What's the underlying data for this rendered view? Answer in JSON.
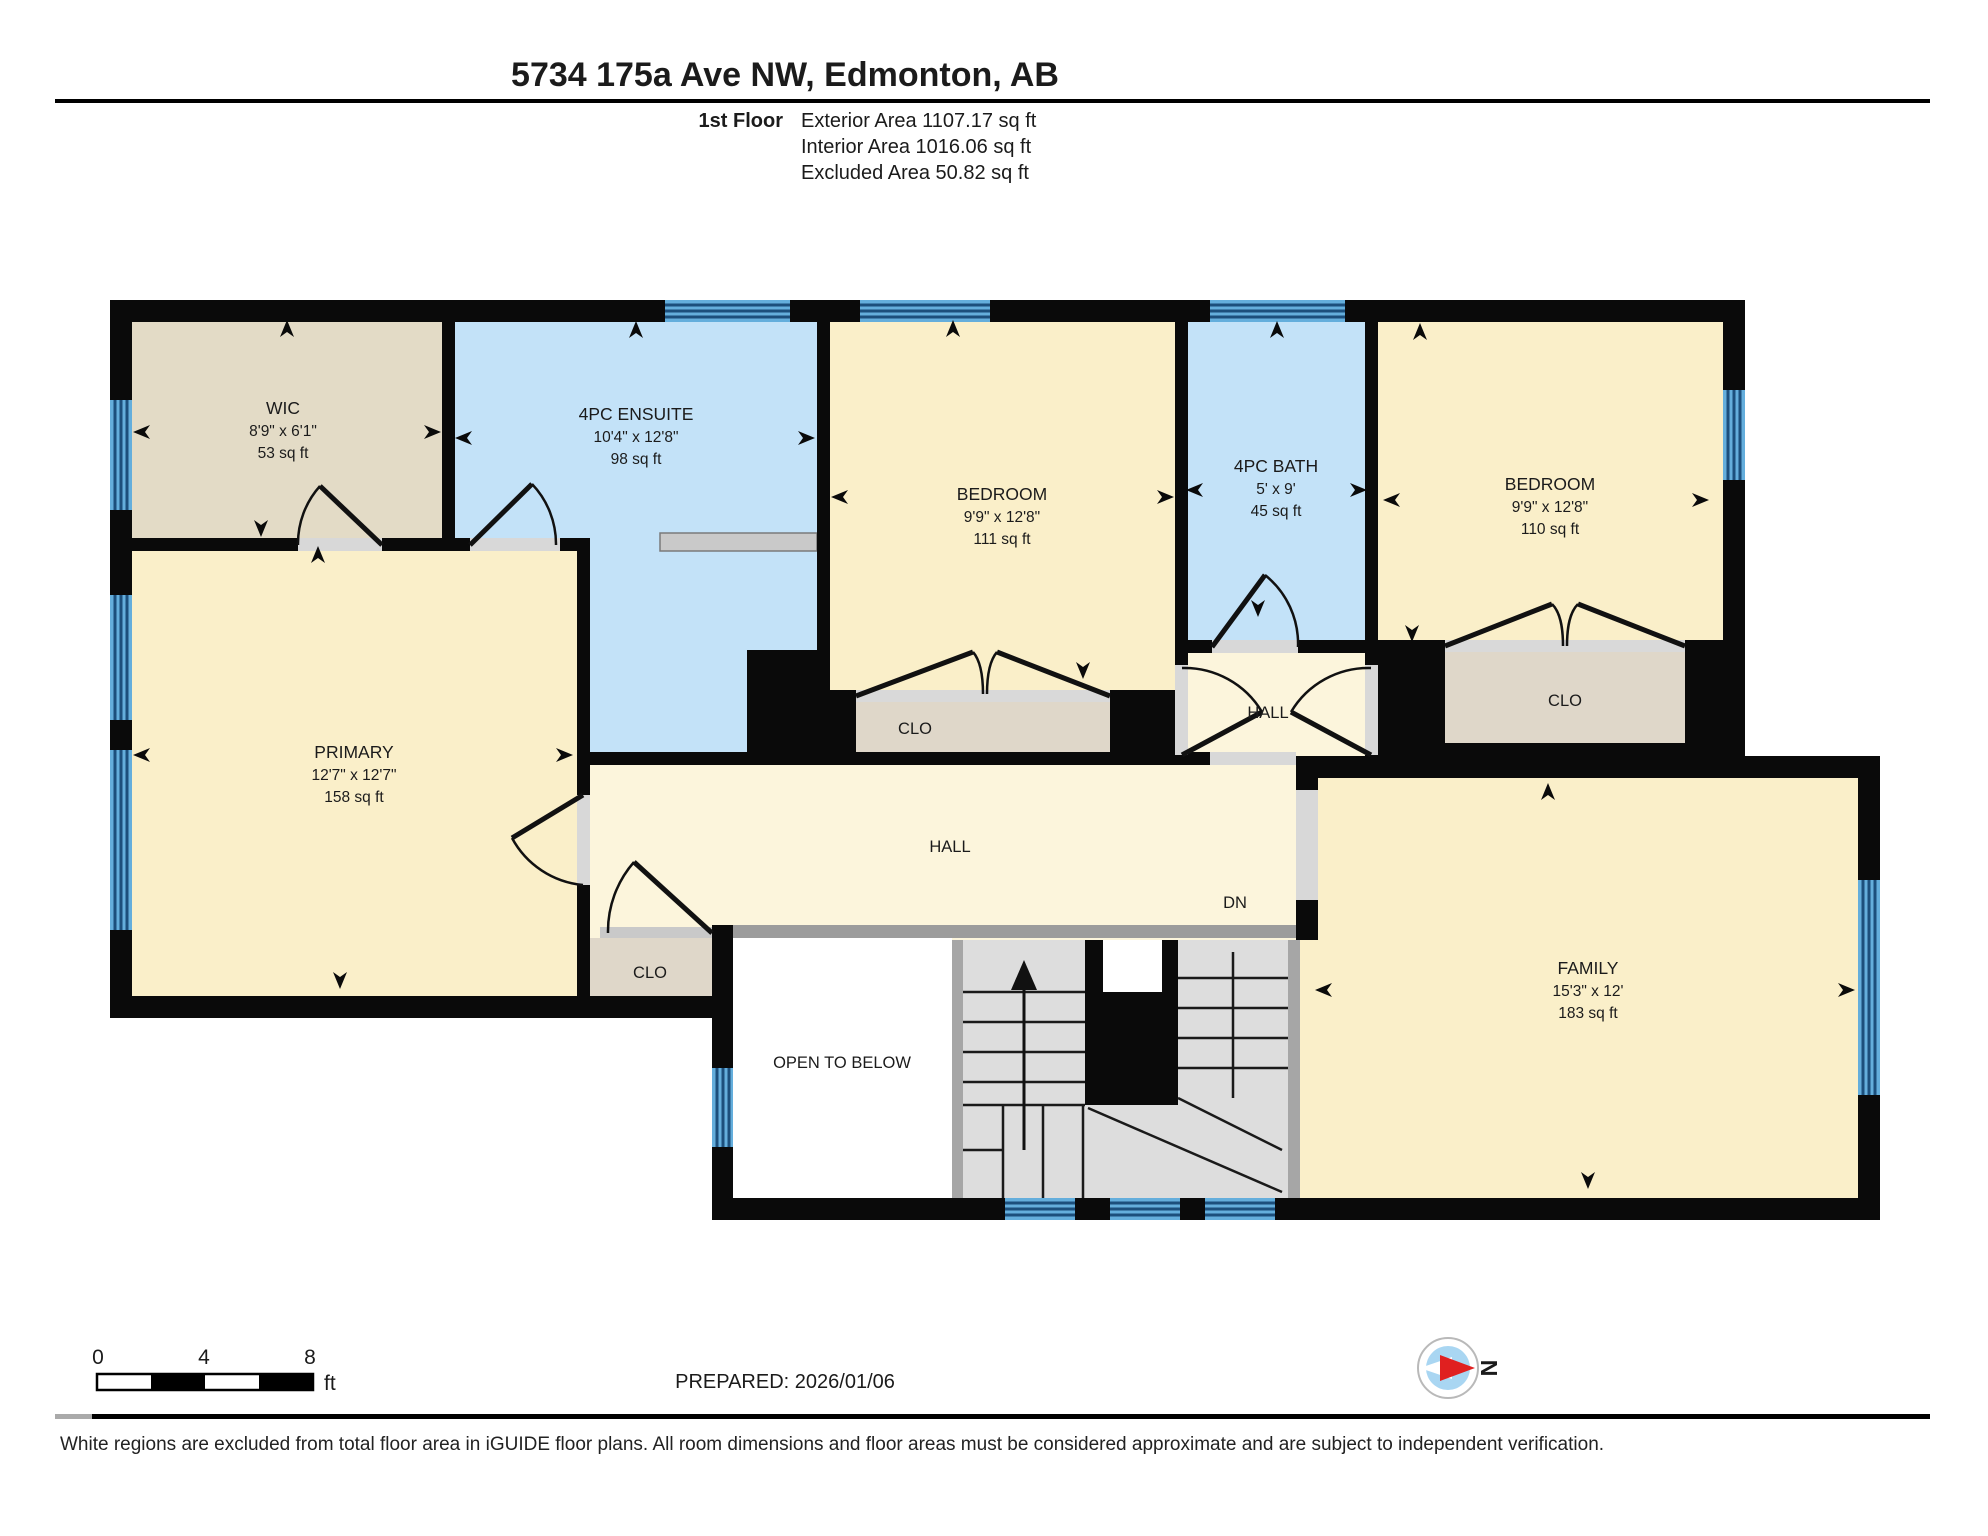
{
  "header": {
    "title": "5734 175a Ave NW, Edmonton, AB",
    "floor_label": "1st Floor",
    "stats": [
      "Exterior Area 1107.17 sq ft",
      "Interior Area 1016.06 sq ft",
      "Excluded Area 50.82 sq ft"
    ]
  },
  "rooms": {
    "wic": {
      "name": "WIC",
      "dims": "8'9\" x 6'1\"",
      "area": "53 sq ft"
    },
    "ensuite": {
      "name": "4PC ENSUITE",
      "dims": "10'4\" x 12'8\"",
      "area": "98 sq ft"
    },
    "bedroom1": {
      "name": "BEDROOM",
      "dims": "9'9\" x 12'8\"",
      "area": "111 sq ft"
    },
    "bath": {
      "name": "4PC BATH",
      "dims": "5' x 9'",
      "area": "45 sq ft"
    },
    "bedroom2": {
      "name": "BEDROOM",
      "dims": "9'9\" x 12'8\"",
      "area": "110 sq ft"
    },
    "primary": {
      "name": "PRIMARY",
      "dims": "12'7\" x 12'7\"",
      "area": "158 sq ft"
    },
    "family": {
      "name": "FAMILY",
      "dims": "15'3\" x 12'",
      "area": "183 sq ft"
    },
    "hall_small": {
      "name": "HALL"
    },
    "hall_main": {
      "name": "HALL"
    },
    "clo_bedroom1": {
      "name": "CLO"
    },
    "clo_bedroom2": {
      "name": "CLO"
    },
    "clo_hall": {
      "name": "CLO"
    },
    "open_below": {
      "name": "OPEN TO BELOW"
    },
    "dn": {
      "name": "DN"
    }
  },
  "footer": {
    "scale": {
      "t0": "0",
      "t4": "4",
      "t8": "8",
      "unit": "ft"
    },
    "prepared": "PREPARED: 2026/01/06",
    "compass_label": "N",
    "disclaimer": "White regions are excluded from total floor area in iGUIDE floor plans. All room dimensions and floor areas must be considered approximate and are subject to independent verification."
  },
  "colors": {
    "room_yellow": "#FAEFC9",
    "hall_cream": "#FCF5DC",
    "bath_blue": "#C3E2F8",
    "closet_tan": "#DFD7C9",
    "wic_tan": "#E3DBC6",
    "window_blue": "#64AEDC",
    "wall_black": "#0a0a0a",
    "stairs_gray": "#DDDDDD",
    "railing_gray": "#9C9C9C",
    "compass_red": "#E02020"
  }
}
